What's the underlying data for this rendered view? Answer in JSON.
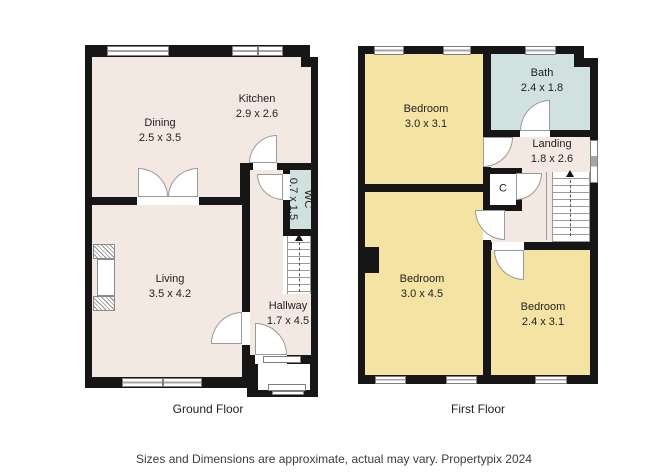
{
  "colors": {
    "wall": "#161616",
    "room": "#f4e8e2",
    "bedroom": "#f5e3a4",
    "bath": "#d0e1df"
  },
  "ground_floor": {
    "floor_label": "Ground Floor",
    "rooms": {
      "dining": {
        "name": "Dining",
        "dims": "2.5 x 3.5"
      },
      "kitchen": {
        "name": "Kitchen",
        "dims": "2.9 x 2.6"
      },
      "living": {
        "name": "Living",
        "dims": "3.5 x 4.2"
      },
      "hallway": {
        "name": "Hallway",
        "dims": "1.7 x 4.5"
      },
      "wc": {
        "name": "WC",
        "dims": "0.7 x 1.5"
      }
    }
  },
  "first_floor": {
    "floor_label": "First Floor",
    "rooms": {
      "bedroom_front": {
        "name": "Bedroom",
        "dims": "3.0 x 3.1"
      },
      "bath": {
        "name": "Bath",
        "dims": "2.4 x 1.8"
      },
      "landing": {
        "name": "Landing",
        "dims": "1.8 x 2.6"
      },
      "cupboard": {
        "name": "C"
      },
      "bedroom_main": {
        "name": "Bedroom",
        "dims": "3.0 x 4.5"
      },
      "bedroom_back": {
        "name": "Bedroom",
        "dims": "2.4 x 3.1"
      }
    }
  },
  "footer": {
    "disclaimer": "Sizes and Dimensions are approximate, actual may vary. Propertypix 2024"
  }
}
